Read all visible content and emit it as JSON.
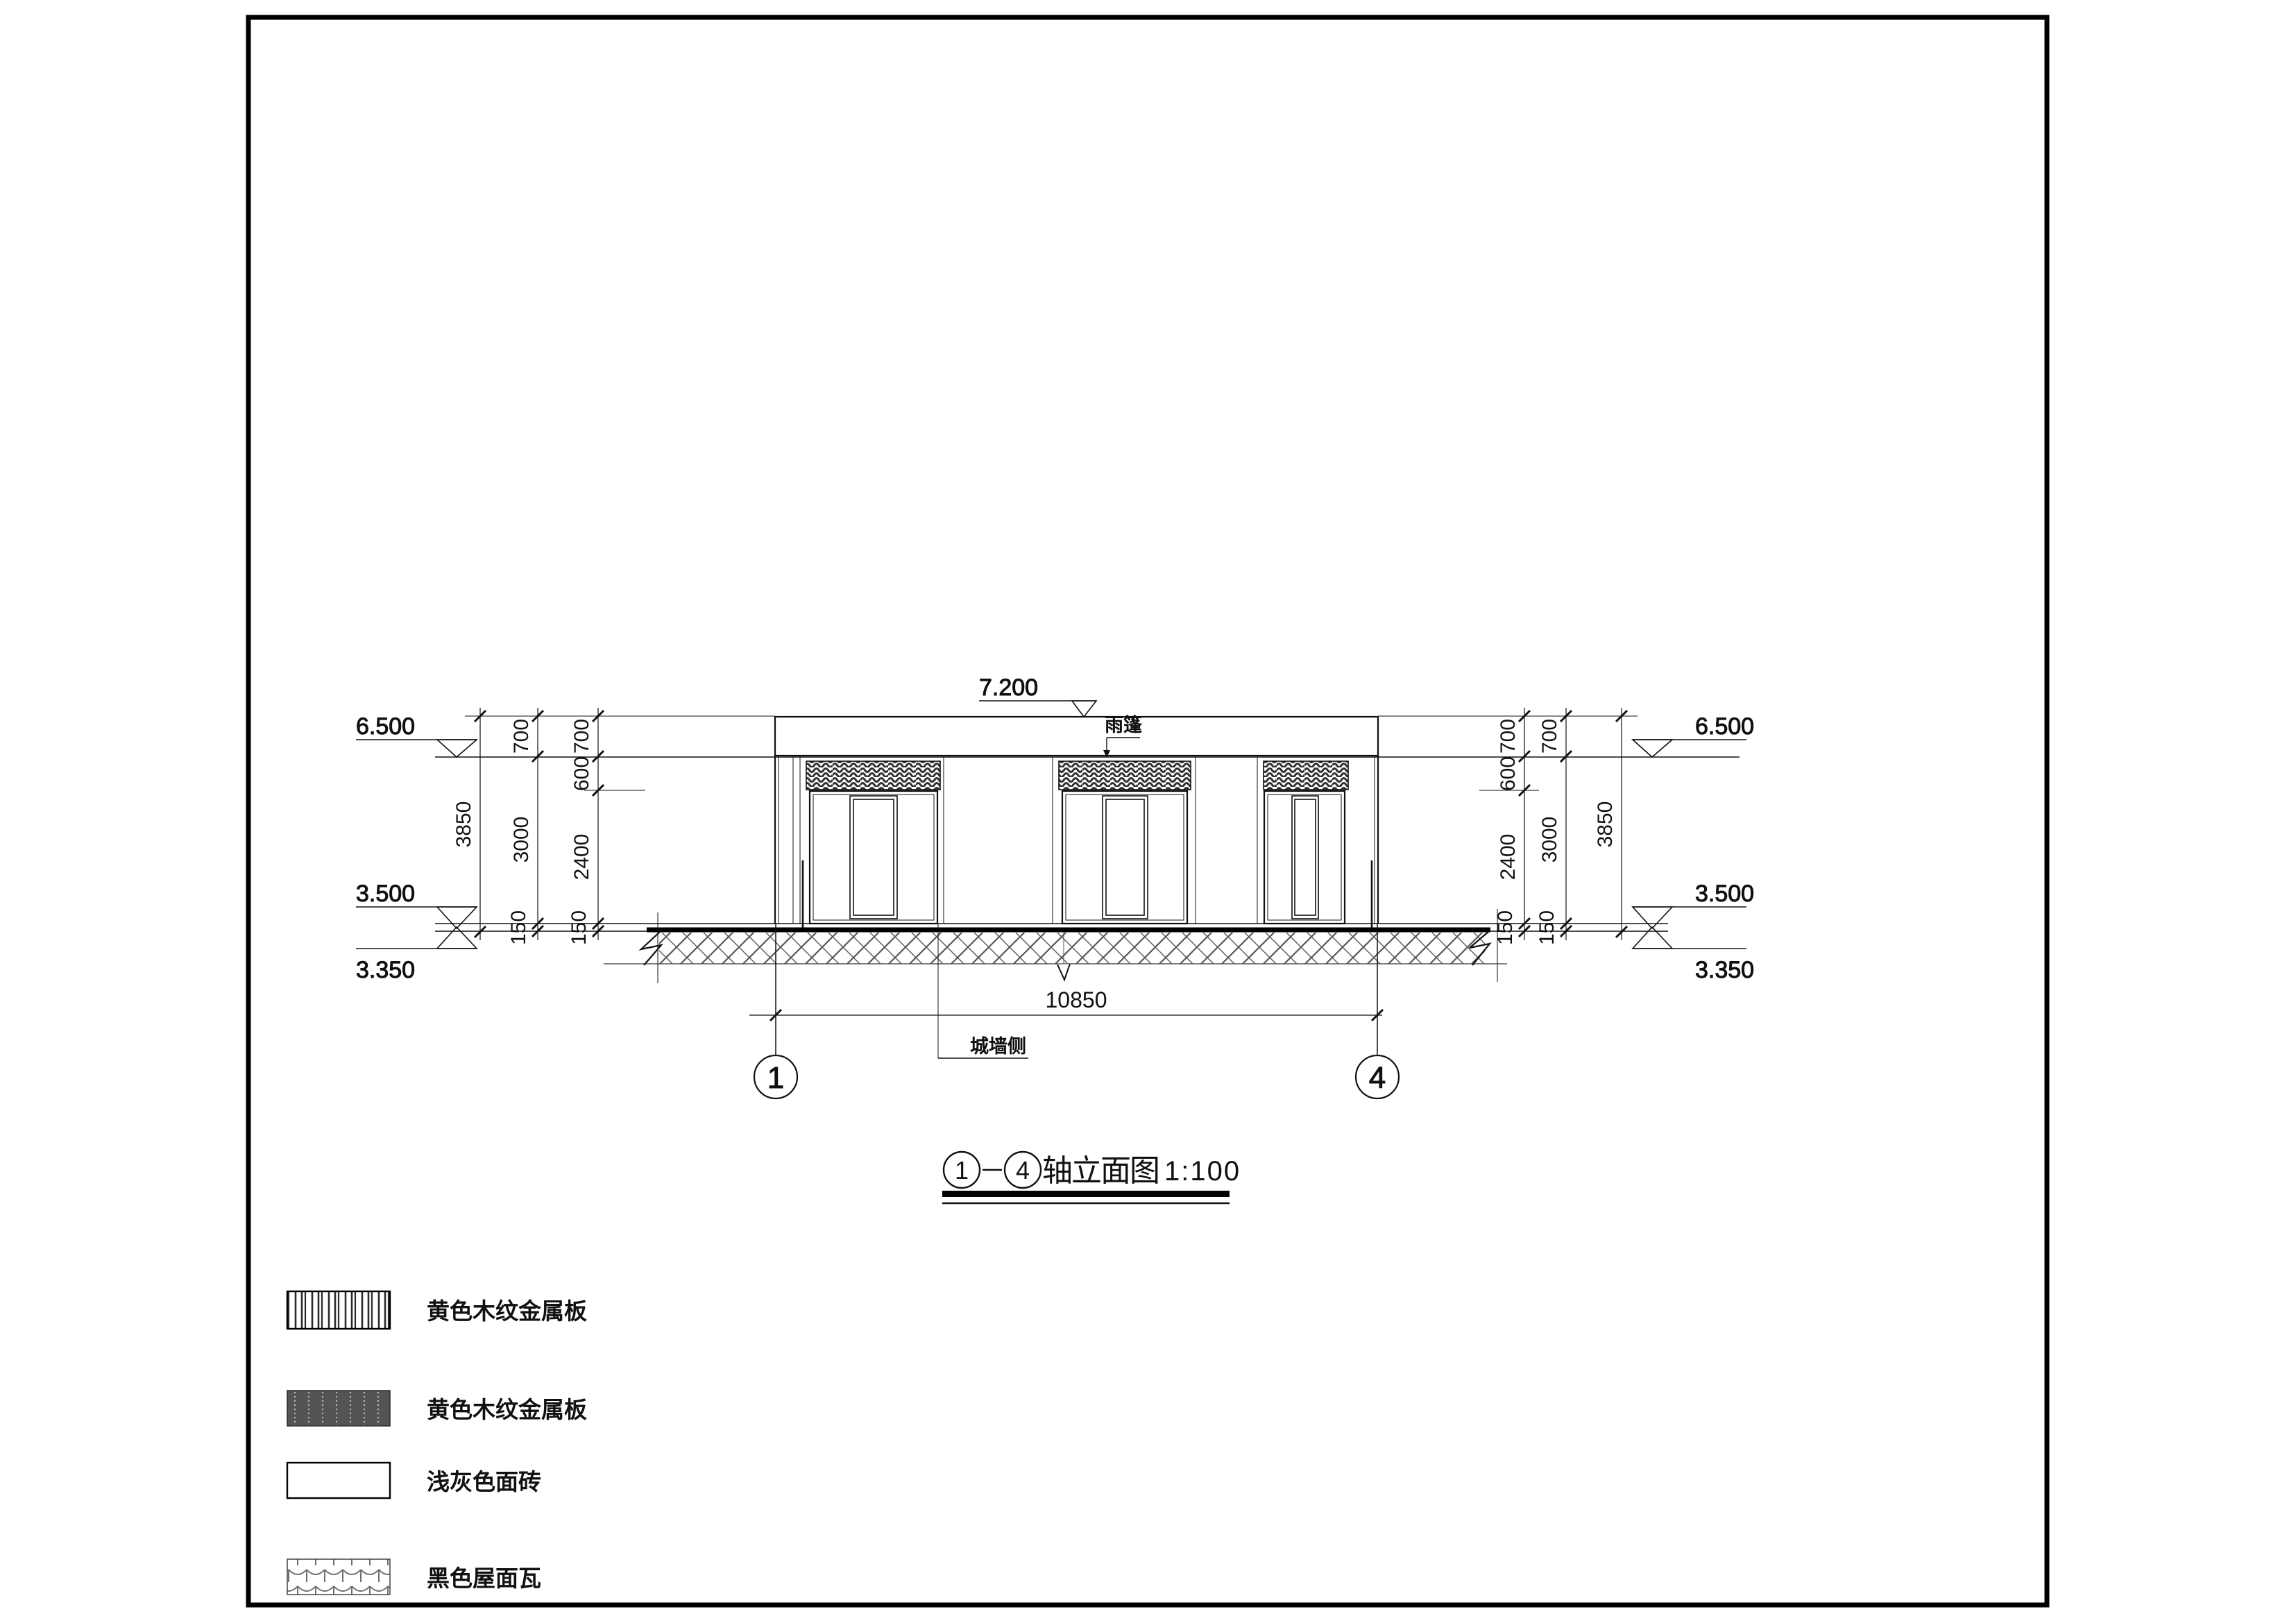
{
  "markers": {
    "top": "7.200",
    "left_6500": "6.500",
    "left_3500": "3.500",
    "left_3350": "3.350",
    "right_6500": "6.500",
    "right_3500": "3.500",
    "right_3350": "3.350"
  },
  "dims": {
    "overall": "10850",
    "left_outer": "3850",
    "left_mid_700": "700",
    "left_mid_3000": "3000",
    "left_mid_150": "150",
    "left_in_700": "700",
    "left_in_600": "600",
    "left_in_2400": "2400",
    "left_in_150": "150",
    "right_outer": "3850",
    "right_mid_700": "700",
    "right_mid_3000": "3000",
    "right_mid_150": "150",
    "right_in_700": "700",
    "right_in_600": "600",
    "right_in_2400": "2400",
    "right_in_150": "150"
  },
  "notes": {
    "canopy": "雨篷",
    "wall_side": "城墙侧"
  },
  "axes": {
    "a1": "1",
    "a4": "4"
  },
  "title": {
    "from": "1",
    "to": "4",
    "name": "轴立面图",
    "scale": "1:100"
  },
  "legend": {
    "items": [
      {
        "label": "黄色木纹金属板",
        "pattern": "vertical-stripes"
      },
      {
        "label": "黄色木纹金属板",
        "pattern": "dark-metal-panel"
      },
      {
        "label": "浅灰色面砖",
        "pattern": "plain-white"
      },
      {
        "label": "黑色屋面瓦",
        "pattern": "roof-tiles"
      }
    ]
  },
  "colors": {
    "line": "#111111",
    "hatch_gray": "#565656",
    "dark_panel": "#545454"
  }
}
